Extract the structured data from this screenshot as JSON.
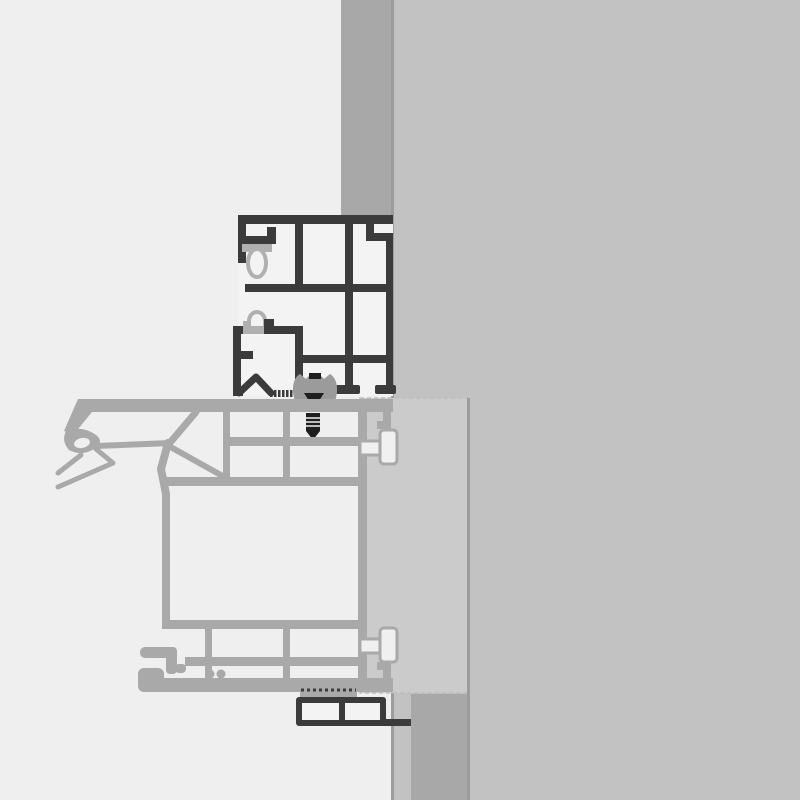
{
  "canvas": {
    "width": 800,
    "height": 800
  },
  "colors": {
    "bg": "#efefef",
    "wall": "#c2c2c2",
    "wallBand": "#a8a8a8",
    "edgeLine": "#9c9c9c",
    "panel": "#cbcbcb",
    "panelEdge": "#bdbdbd",
    "frame": "#3b3b3b",
    "chamber": "#f3f3f3",
    "accessory": "#b0b0b0",
    "sash": "#a9a9a9",
    "connectorFill": "#f0f0f0",
    "hardware": "#1e1e1e",
    "clip": "#9b9b9b"
  },
  "components": {
    "drawing": "window-installation-cross-section",
    "wall": "masonry-wall",
    "wall_reveal_top": "wall-reveal-band-top",
    "wall_reveal_bottom": "wall-reveal-band-bottom",
    "panel": "infill-panel",
    "frame": "outer-frame-profile",
    "frame_gasket_upper": "teardrop-gasket",
    "frame_gasket_lower": "arch-gasket",
    "clip": "glazing-clip",
    "screw": "fastening-screw",
    "sash": "sash-profile",
    "sash_seal": "sash-seal-left",
    "connector_top": "t-connector-top",
    "connector_bottom": "t-connector-bottom",
    "sill": "sill-adapter-profile"
  }
}
